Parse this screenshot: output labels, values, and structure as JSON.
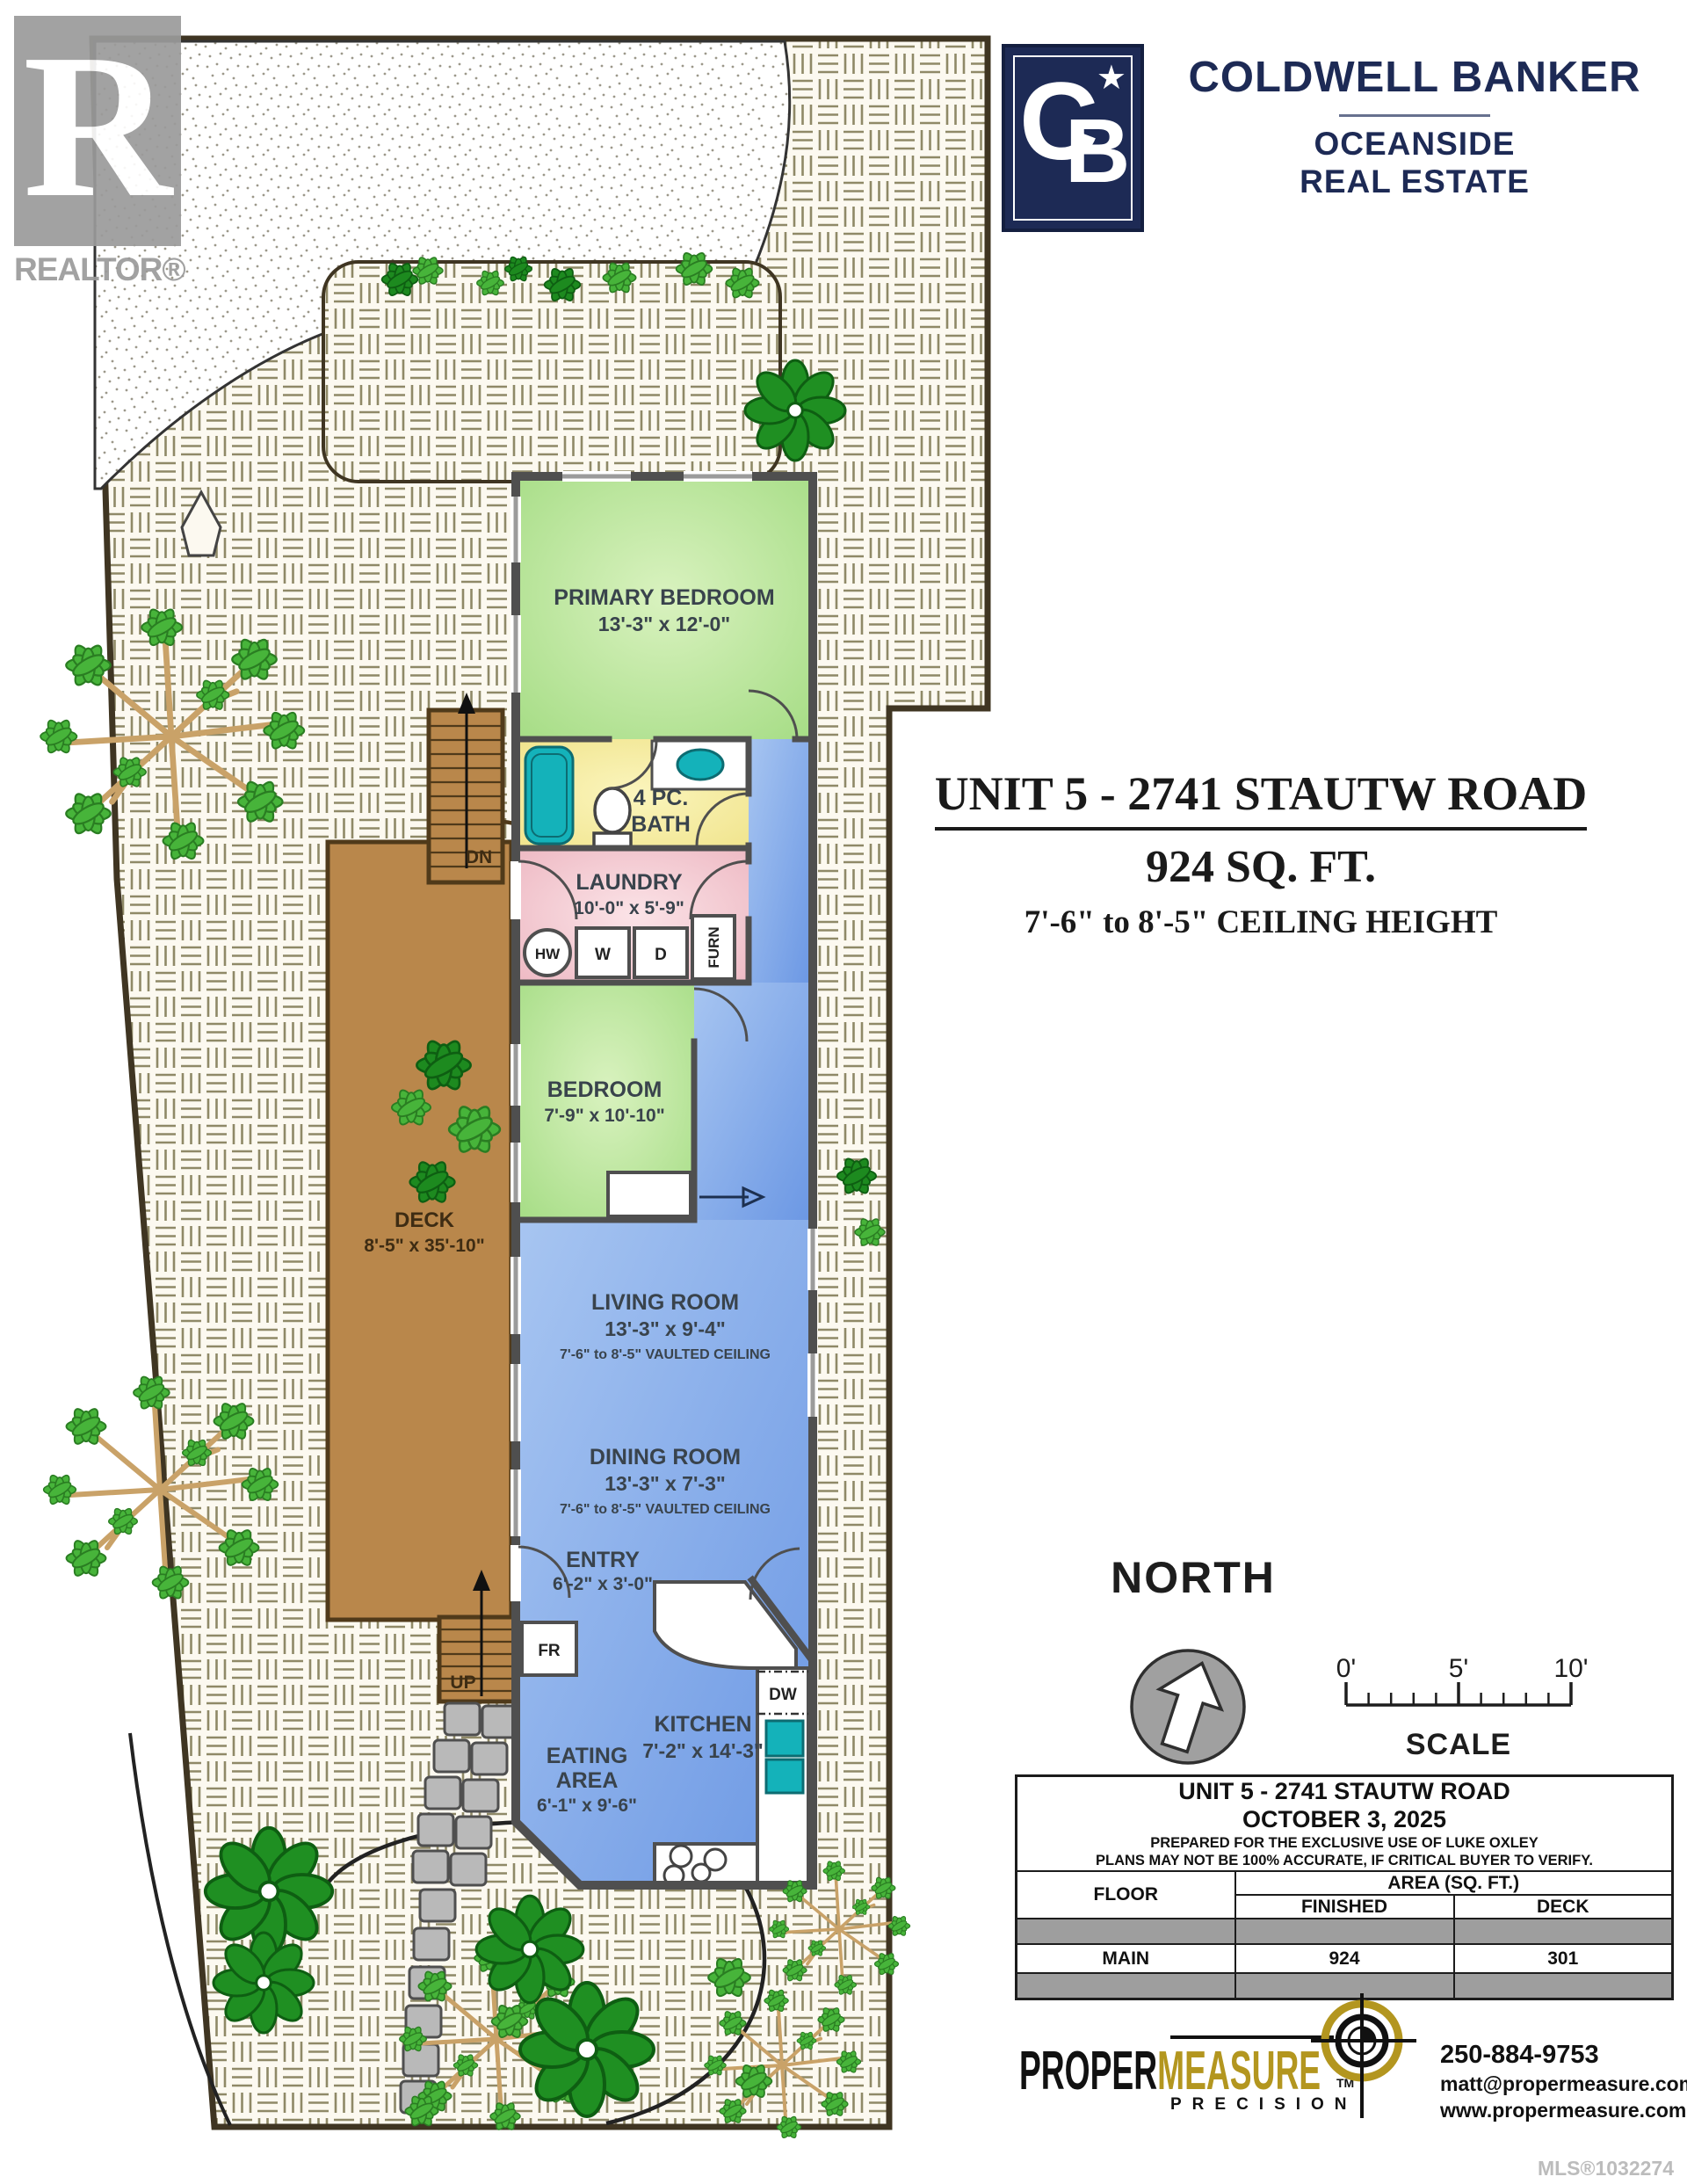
{
  "colors": {
    "cb_navy": "#1d2a55",
    "pm_gold": "#b3961f",
    "deck_brown": "#b9874b",
    "lot_line": "#3f3522",
    "room_green": "#b4e498",
    "room_blue": "#84ace8",
    "bath_yellow": "#f5eda0",
    "laundry_pink": "#f1c3cb",
    "teal_fixture": "#14b2ba",
    "logo_gray": "#9b9b9b"
  },
  "realtor": {
    "letter": "R",
    "label": "REALTOR®"
  },
  "coldwell": {
    "monogram_c": "C",
    "monogram_b": "B",
    "star": "★",
    "name": "COLDWELL BANKER",
    "office1": "OCEANSIDE",
    "office2": "REAL ESTATE"
  },
  "title": {
    "line1": "UNIT 5 - 2741 STAUTW ROAD",
    "line2": "924 SQ. FT.",
    "line3": "7'-6\" to 8'-5\" CEILING HEIGHT"
  },
  "rooms": {
    "primary": {
      "name": "PRIMARY BEDROOM",
      "dims": "13'-3\" x 12'-0\""
    },
    "bath": {
      "line1": "4 PC.",
      "line2": "BATH"
    },
    "laundry": {
      "name": "LAUNDRY",
      "dims": "10'-0\" x 5'-9\""
    },
    "bedroom": {
      "name": "BEDROOM",
      "dims": "7'-9\" x 10'-10\""
    },
    "living": {
      "name": "LIVING ROOM",
      "dims": "13'-3\" x 9'-4\"",
      "note": "7'-6\" to 8'-5\" VAULTED CEILING"
    },
    "dining": {
      "name": "DINING ROOM",
      "dims": "13'-3\" x 7'-3\"",
      "note": "7'-6\" to 8'-5\" VAULTED CEILING"
    },
    "entry": {
      "name": "ENTRY",
      "dims": "6'-2\" x 3'-0\""
    },
    "kitchen": {
      "name": "KITCHEN",
      "dims": "7'-2\" x 14'-3\""
    },
    "eating": {
      "line1": "EATING",
      "line2": "AREA",
      "dims": "6'-1\" x 9'-6\""
    },
    "deck": {
      "name": "DECK",
      "dims": "8'-5\" x 35'-10\""
    }
  },
  "fixtures": {
    "hot_water": "HW",
    "washer": "W",
    "dryer": "D",
    "furnace": "FURN",
    "fridge": "FR",
    "dishwasher": "DW",
    "stairs_down": "DN",
    "stairs_up": "UP"
  },
  "compass": {
    "label": "NORTH"
  },
  "scalebar": {
    "t0": "0'",
    "t5": "5'",
    "t10": "10'",
    "label": "SCALE"
  },
  "table": {
    "title": "UNIT 5 - 2741 STAUTW ROAD",
    "date": "OCTOBER 3, 2025",
    "prepared": "PREPARED FOR THE EXCLUSIVE USE OF LUKE OXLEY",
    "disclaimer": "PLANS MAY NOT BE 100% ACCURATE, IF CRITICAL BUYER TO VERIFY.",
    "col_floor": "FLOOR",
    "col_area": "AREA (SQ. FT.)",
    "col_finished": "FINISHED",
    "col_deck": "DECK",
    "rows": [
      {
        "floor": "MAIN",
        "finished": "924",
        "deck": "301"
      }
    ]
  },
  "footer": {
    "logo_part1": "PROPER",
    "logo_part2": "MEASURE",
    "logo_tm": "TM",
    "logo_sub": "PRECISION",
    "phone": "250-884-9753",
    "email": "matt@propermeasure.com",
    "website": "www.propermeasure.com",
    "mls": "MLS®1032274"
  }
}
